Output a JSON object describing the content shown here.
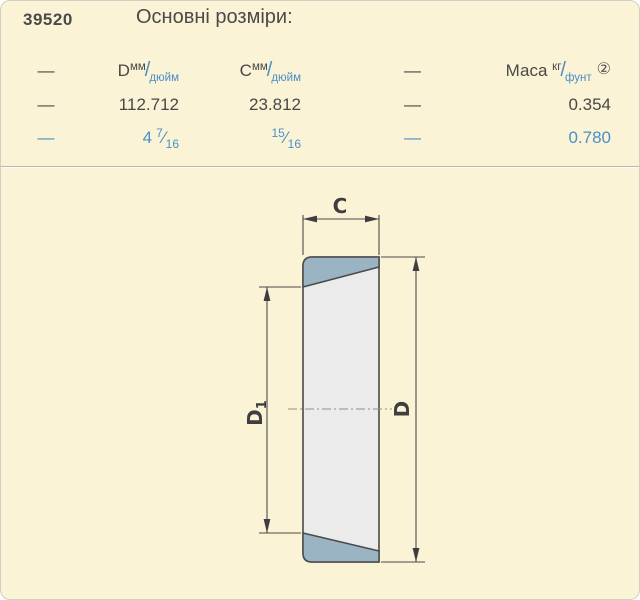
{
  "part_number": "39520",
  "title": "Основні розміри:",
  "table": {
    "dash": "—",
    "slash": "/",
    "frac_slash": "⁄",
    "header": {
      "d": "D",
      "c": "C",
      "mass": "Маса",
      "unit_top": "мм",
      "unit_bottom": "дюйм",
      "mass_top": "кг",
      "mass_bottom": "фунт",
      "note": "②"
    },
    "row_mm": {
      "dash1": "—",
      "d": "112.712",
      "c": "23.812",
      "dash2": "—",
      "mass": "0.354"
    },
    "row_inch": {
      "dash1": "—",
      "d_whole": "4",
      "d_num": "7",
      "d_den": "16",
      "c_num": "15",
      "c_den": "16",
      "dash2": "—",
      "mass": "0.780"
    }
  },
  "drawing": {
    "label_c": "C",
    "label_d": "D",
    "label_d1_main": "D",
    "label_d1_sub": "1"
  },
  "colors": {
    "background": "#fbf3d5",
    "text_dark": "#484848",
    "accent_blue": "#4a8fc8",
    "fill_steel_blue": "#9ab4c3",
    "fill_bore": "#ebebeb",
    "line_dark": "#4a4a4b"
  }
}
